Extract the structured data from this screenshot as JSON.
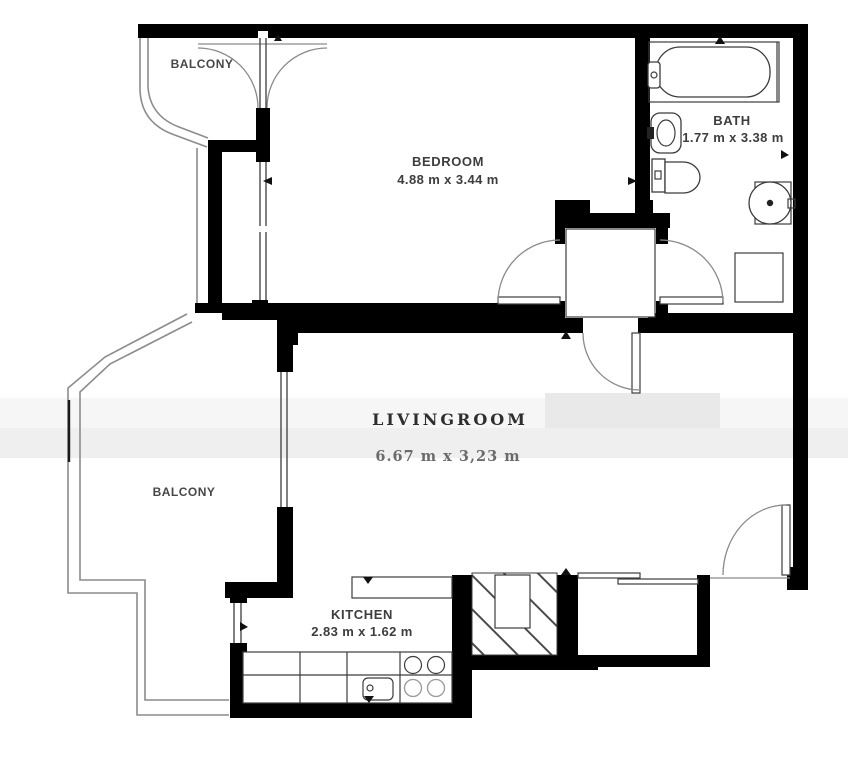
{
  "rooms": {
    "balcony_top": {
      "label": "BALCONY"
    },
    "bedroom": {
      "label": "BEDROOM",
      "dimensions": "4.88 m x 3.44 m"
    },
    "bath": {
      "label": "BATH",
      "dimensions": "1.77 m x 3.38 m"
    },
    "livingroom": {
      "label": "LIVINGROOM",
      "dimensions": "6.67 m x 3,23 m"
    },
    "balcony_left": {
      "label": "BALCONY"
    },
    "kitchen": {
      "label": "KITCHEN",
      "dimensions": "2.83 m x 1.62 m"
    }
  },
  "colors": {
    "wall": "#000000",
    "balcony_outline": "#8c8c8c",
    "label": "#3d3d3d",
    "livingroom_label": "#2e2e2e",
    "dims_muted": "#6b6b6b",
    "band_light": "#f6f6f6",
    "band_mid": "#efefef",
    "paper": "#ffffff"
  },
  "fixtures": [
    "bathtub",
    "wash-basin",
    "toilet",
    "washing-machine",
    "shower",
    "hall-closet",
    "kitchen-counter",
    "kitchen-sink",
    "stove",
    "ventilation-shaft"
  ]
}
